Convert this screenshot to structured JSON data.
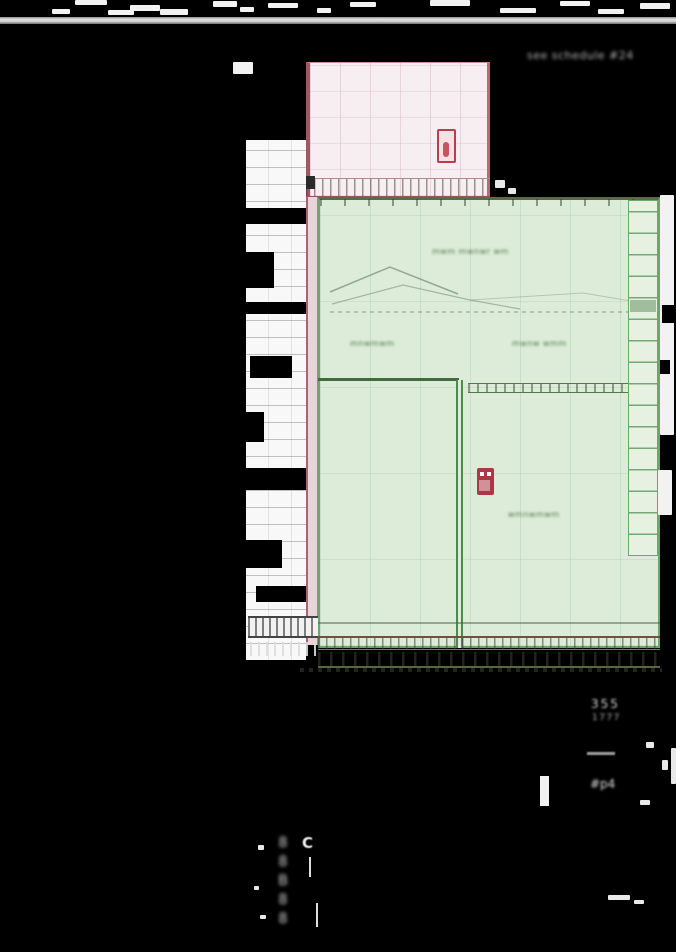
{
  "colors": {
    "background": "#000000",
    "highlight_green_fill": "#dcecd8",
    "highlight_green_border": "#69a869",
    "highlight_pink_fill": "#f7eef1",
    "highlight_pink_border": "#c9939f",
    "marker_red": "#b5404e",
    "ruler_gray": "#d3d3d3"
  },
  "icons": {
    "pink_marker": "door-tag-icon",
    "green_marker": "elevator-icon"
  },
  "annotations": {
    "top_right": "see schedule #24",
    "upper_hall_center": "mwm mwnwr wm",
    "upper_hall_left": "mnwmwm",
    "upper_hall_right": "mwnw wmm",
    "lower_hall_label": "wmnwmwm"
  },
  "footer": {
    "line1": "355",
    "line2": "1777",
    "tag": "#p4"
  },
  "bottom_left": {
    "letter": "C",
    "glyph_column": "8\n8\nB\n8\n8"
  }
}
